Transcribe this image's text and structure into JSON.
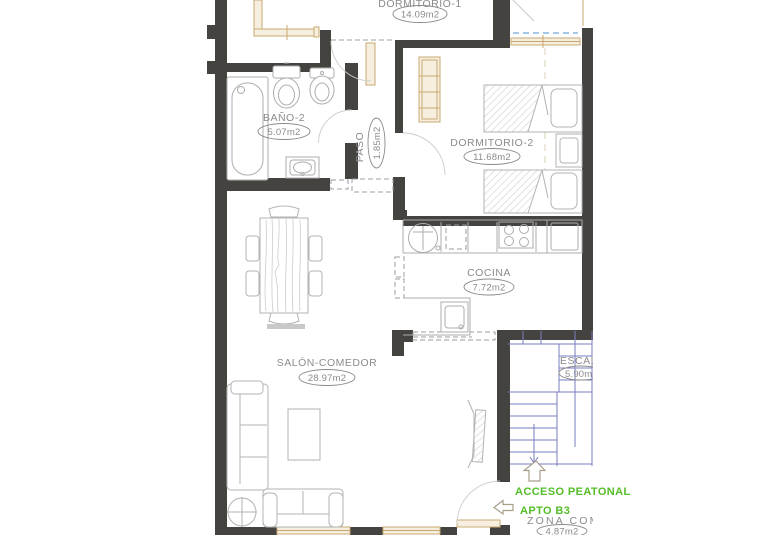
{
  "plan": {
    "rooms": {
      "dormitorio1": {
        "name": "DORMITORIO-1",
        "area": "14.09m2"
      },
      "bano2": {
        "name": "BAÑO-2",
        "area": "5.07m2"
      },
      "paso": {
        "name": "PASO",
        "area": "1.85m2"
      },
      "dormitorio2": {
        "name": "DORMITORIO-2",
        "area": "11.68m2"
      },
      "cocina": {
        "name": "COCINA",
        "area": "7.72m2"
      },
      "salon": {
        "name": "SALÓN-COMEDOR",
        "area": "28.97m2"
      },
      "escalera": {
        "name": "ESCALERA",
        "area": "5.90m2"
      },
      "zona_comun": {
        "name": "ZONA COMÚN",
        "area": "4.87m2"
      }
    },
    "annotations": {
      "acceso_peatonal": "ACCESO PEATONAL",
      "apto": "APTO B3"
    },
    "colors": {
      "wall": "#45433f",
      "fixture_outline": "#adadad",
      "carpentry_wood": "#c9a870",
      "stairs_blue": "#7a7dc1",
      "glazing_blue": "#6fa8d8",
      "label_gray": "#8b8b8b",
      "annotation_green": "#54bd28"
    }
  }
}
